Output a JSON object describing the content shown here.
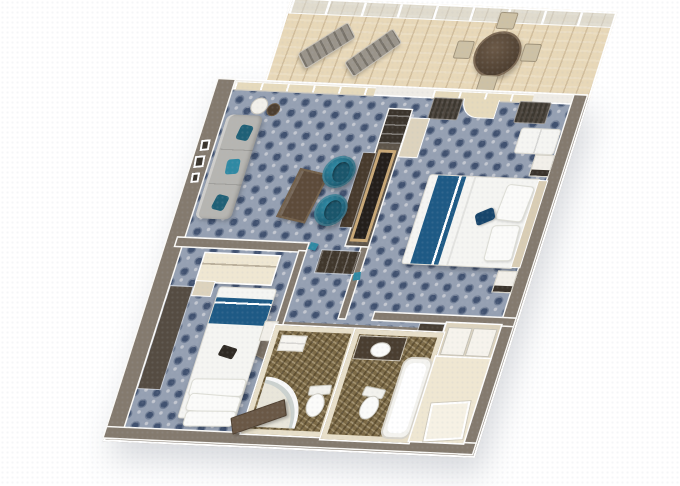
{
  "scene": {
    "subject": "3D cutaway floor plan render of a two-bedroom cruise-ship suite with wraparound balcony",
    "background": "#ffffff"
  },
  "colors": {
    "bg": "#ffffff",
    "wall": "#847a6e",
    "wall_dark": "#5e554a",
    "wall_edge": "#fbfaf7",
    "carpet": "#95a0b2",
    "carpet_motif": "#415270",
    "carpet_speck": "#c3c7d0",
    "wood": "#e8d8b8",
    "bath_floor": "#7c6a46",
    "bath_wall": "#e8dfc9",
    "glass_tint": "#e6dabc",
    "teal": "#1f6076",
    "teal_hi": "#2f89a3",
    "navy": "#1e5a85",
    "navy_dark": "#17456b",
    "white_fabric": "#f5f5f2",
    "sofa": "#b6b5b1",
    "dark_wood": "#483b2d",
    "tan_frame": "#c9a876",
    "curtain": "#4f4840",
    "curtain_dark": "#3d3830",
    "beige": "#ddd3bd",
    "beige_light": "#efe7d2",
    "table_wood": "#5d4b3a",
    "chair_tan": "#cdc1a5",
    "lounger": "#9a948a"
  },
  "rooms": [
    {
      "id": "balcony",
      "label": "Balcony"
    },
    {
      "id": "living-room",
      "label": "Living Room"
    },
    {
      "id": "master-bedroom",
      "label": "Master Bedroom"
    },
    {
      "id": "second-bedroom",
      "label": "Second Bedroom"
    },
    {
      "id": "hallway",
      "label": "Hallway"
    },
    {
      "id": "bathroom-shower",
      "label": "Bathroom with Shower"
    },
    {
      "id": "bathroom-tub",
      "label": "Bathroom with Tub"
    },
    {
      "id": "closet",
      "label": "Closet / Dressing Area"
    }
  ],
  "furniture": {
    "balcony": [
      "lounge chair",
      "lounge chair",
      "round dining table",
      "patio chair",
      "patio chair",
      "patio chair",
      "patio chair",
      "glass railing"
    ],
    "living_room": [
      "sofa",
      "teal throw pillows",
      "side tables",
      "coffee table",
      "teal swivel chair",
      "teal swivel chair",
      "wall art",
      "media console"
    ],
    "master_bedroom": [
      "double bed",
      "blue bed runner",
      "pillows",
      "accent pillow",
      "nightstand",
      "nightstand",
      "window bench",
      "curtains",
      "wardrobe",
      "closet doors"
    ],
    "second_bedroom": [
      "twin bed",
      "blue bed runner",
      "pillow stack",
      "desk",
      "wardrobe",
      "porthole door"
    ],
    "bathroom_shower": [
      "curved shower",
      "toilet",
      "towel shelf"
    ],
    "bathroom_tub": [
      "vanity with sink",
      "toilet",
      "bathtub"
    ],
    "hallway": [
      "storage cabinet",
      "entry door"
    ]
  }
}
